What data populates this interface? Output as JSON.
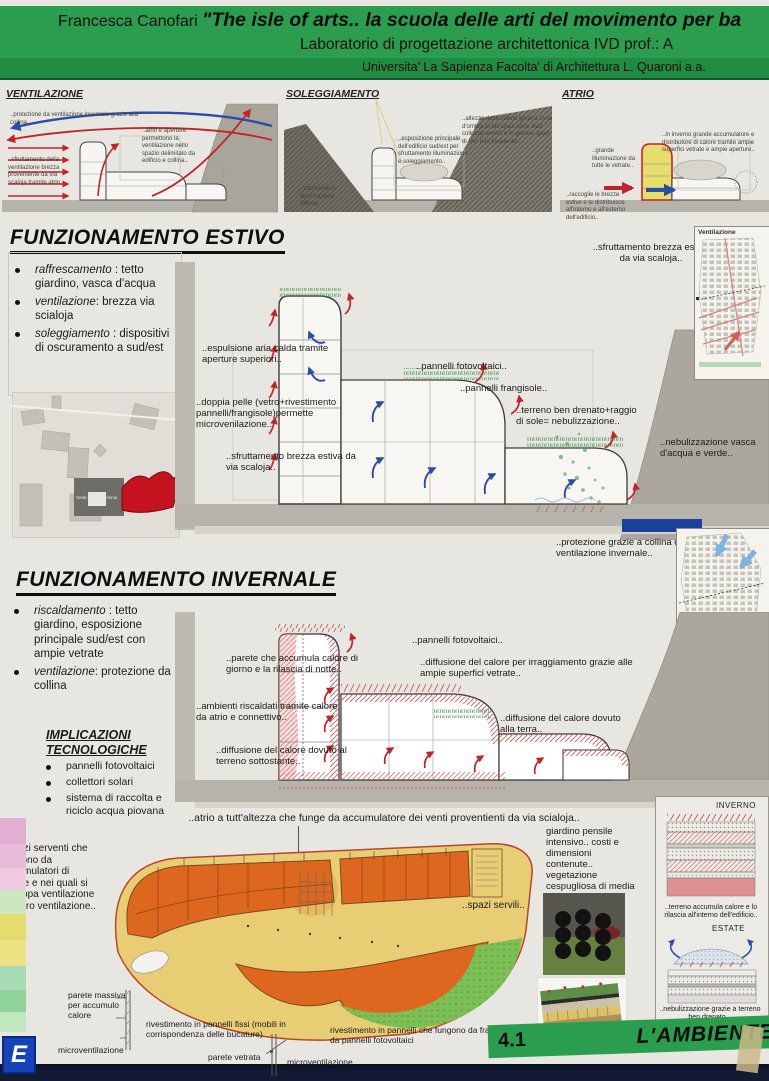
{
  "colors": {
    "header_green": "#2a9e4e",
    "arrow_red": "#c2232a",
    "arrow_blue": "#2b4da8",
    "plan_orange": "#dd671f",
    "plan_yellow": "#e8cd74",
    "plan_lawn": "#7cbf55",
    "atrium_yellow": "#e5de6d"
  },
  "header": {
    "author": "Francesca Canofari",
    "title": "\"The isle of arts.. la scuola delle arti del movimento per ba",
    "course": "Laboratorio di progettazione architettonica IVD   prof.: A",
    "university": "Universita' La Sapienza  Facolta' di Architettura L. Quaroni  a.a."
  },
  "top_diagrams": {
    "ventilazione": {
      "title": "VENTILAZIONE",
      "note_collina": "..protezione da ventilazione invernale grazie alla collina..",
      "note_atrio": "..atrio e aperture permettono la ventilazione nello spazio delimitato da edificio e collina..",
      "note_brezza": "..sfruttamento della ventilazione brezza proveniente da via scaloja tramite atrio.."
    },
    "soleggiamento": {
      "title": "SOLEGGIAMENTO",
      "note_diffusa": "..sfruttamento illuminazione diffusa..",
      "note_esposizione": "..esposizione principale dell'edificio sud/est per sfruttamento illuminazione e soleggiamento..",
      "note_ombra": "..altezza della collina genera zone d'ombra,in tali spazi sono stati collocati servizi e in genere spazi di uso non frequente.."
    },
    "atrio": {
      "title": "ATRIO",
      "note_vetrate": "..grande illuminazione da tutte le vetrate..",
      "note_inverno": "..in inverno grande accumulatore e distributore di calore tramite ampie superfici vetrate e ampie aperture..",
      "note_brezze": "..raccoglie le brezze estive e le distribuisce all'interno e all'esterno dell'edificio.."
    }
  },
  "estivo": {
    "heading": "FUNZIONAMENTO ESTIVO",
    "bullets": [
      {
        "lead": "raffrescamento",
        "rest": " : tetto giardino, vasca d'acqua"
      },
      {
        "lead": "ventilazione",
        "rest": ": brezza via scialoja"
      },
      {
        "lead": "soleggiamento",
        "rest": " : dispositivi di oscuramento a sud/est"
      }
    ],
    "notes": {
      "espulsione": "..espulsione aria calda tramite aperture superiori..",
      "fotovoltaici": "..pannelli fotovoltaici..",
      "frangisole": "..pannelli frangisole..",
      "doppia_pelle": "..doppia pelle (vetro+rivestimento pannelli/frangisole)permette microvenilazione..",
      "brezza": "..sfruttamento brezza estiva da via scaloja..",
      "terreno": "..terreno ben drenato+raggio di sole= nebulizzazione..",
      "nebulizzazione": "..nebulizzazione vasca d'acqua e verde..",
      "brezza_alto": "..sfruttamento brezza estiva da via scaloja.."
    },
    "map_title": "Ventilazione",
    "site_label": "Sede di Via Flaminia"
  },
  "invernale": {
    "heading": "FUNZIONAMENTO INVERNALE",
    "bullets": [
      {
        "lead": "riscaldamento",
        "rest": " : tetto giardino, esposizione principale sud/est con ampie vetrate"
      },
      {
        "lead": "ventilazione",
        "rest": ": protezione da collina"
      }
    ],
    "impl_heading": "IMPLICAZIONI TECNOLOGICHE",
    "impl_items": [
      "pannelli fotovoltaici",
      "collettori solari",
      "sistema di raccolta e riciclo acqua piovana"
    ],
    "notes": {
      "protezione": "..protezione grazie a collina da ventilazione invernale..",
      "fotovoltaici": "..pannelli fotovoltaici..",
      "parete": "..parete che accumula calore di giorno e la rilascia di notte..",
      "irraggiamento": "..diffusione del calore per irraggiamento grazie alle ampie superfici vetrate..",
      "ambienti": "..ambienti riscaldati tramite calore da atrio e connettivo..",
      "terra": "..diffusione del calore dovuto alla terra..",
      "sottostante": "..diffusione del calore dovuto al terreno sottostante.."
    }
  },
  "bottom": {
    "caption": "..atrio a tutt'altezza che funge da accumulatore dei venti proventienti da via scialoja..",
    "spazi_serventi": "..spazi serventi che fungono da accumulatori di calore e nei quali si sviluppa ventilazione e micro ventilazione..",
    "spazi_serviti": "..spazi servili..",
    "giardino": "giardino pensile intensivo.. costi e dimensioni contenute.. vegetazione cespugliosa di media grandezza",
    "inverno": "INVERNO",
    "estate": "ESTATE",
    "terreno_accumula": "..terreno accumula calore e lo rilascia all'interno dell'edificio..",
    "nebulizzazione": "..nebulizzazione grazie a terreno ben drenato ..",
    "pareti": {
      "massiva": "parete massiva per accumulo calore",
      "micro1": "microventilazione",
      "fissi": "rivestimento in pannelli fissi (mobili in corrispondenza delle bucature)",
      "vetrata": "parete vetrata",
      "frangisole": "rivestimento in pannelli che fungono da frangisole e da pannelli fotovoltaici",
      "micro2": "microventilazione"
    }
  },
  "footer": {
    "number": "4.1",
    "label": "L'AMBIENTE"
  },
  "misc": {
    "corner_letter": "E"
  }
}
